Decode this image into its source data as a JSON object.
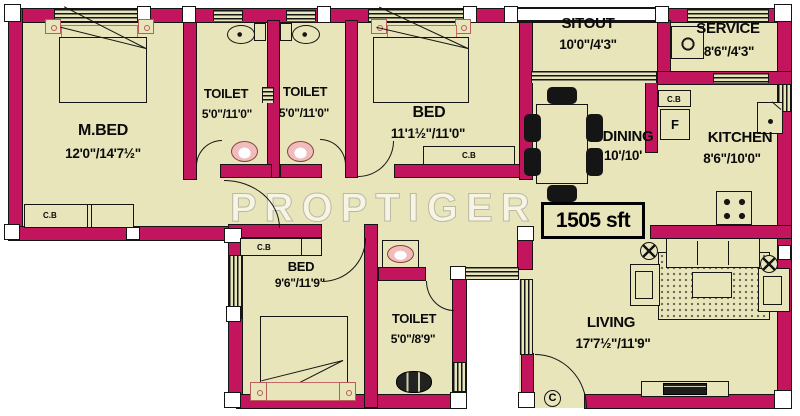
{
  "plan": {
    "rooms": {
      "mbed": {
        "name": "M.BED",
        "dims": "12'0\"/14'7½\""
      },
      "toilet1": {
        "name": "TOILET",
        "dims": "5'0\"/11'0\""
      },
      "toilet2": {
        "name": "TOILET",
        "dims": "5'0\"/11'0\""
      },
      "bed1": {
        "name": "BED",
        "dims": "11'1½\"/11'0\""
      },
      "sitout": {
        "name": "SITOUT",
        "dims": "10'0\"/4'3\""
      },
      "service": {
        "name": "SERVICE",
        "dims": "8'6\"/4'3\""
      },
      "dining": {
        "name": "DINING",
        "dims": "10'/10'"
      },
      "kitchen": {
        "name": "KITCHEN",
        "dims": "8'6\"/10'0\""
      },
      "bed2": {
        "name": "BED",
        "dims": "9'6\"/11'9\""
      },
      "toilet3": {
        "name": "TOILET",
        "dims": "5'0\"/8'9\""
      },
      "living": {
        "name": "LIVING",
        "dims": "17'7½\"/11'9\""
      }
    },
    "labels": {
      "area": "1505 sft",
      "watermark": "PROPTIGER",
      "cupboard": "C.B",
      "fridge": "F",
      "door": "C"
    },
    "colors": {
      "wall": "#c2155e",
      "floor": "#e8e5bb",
      "line": "#151515",
      "fixture": "#f0bcbc"
    }
  }
}
